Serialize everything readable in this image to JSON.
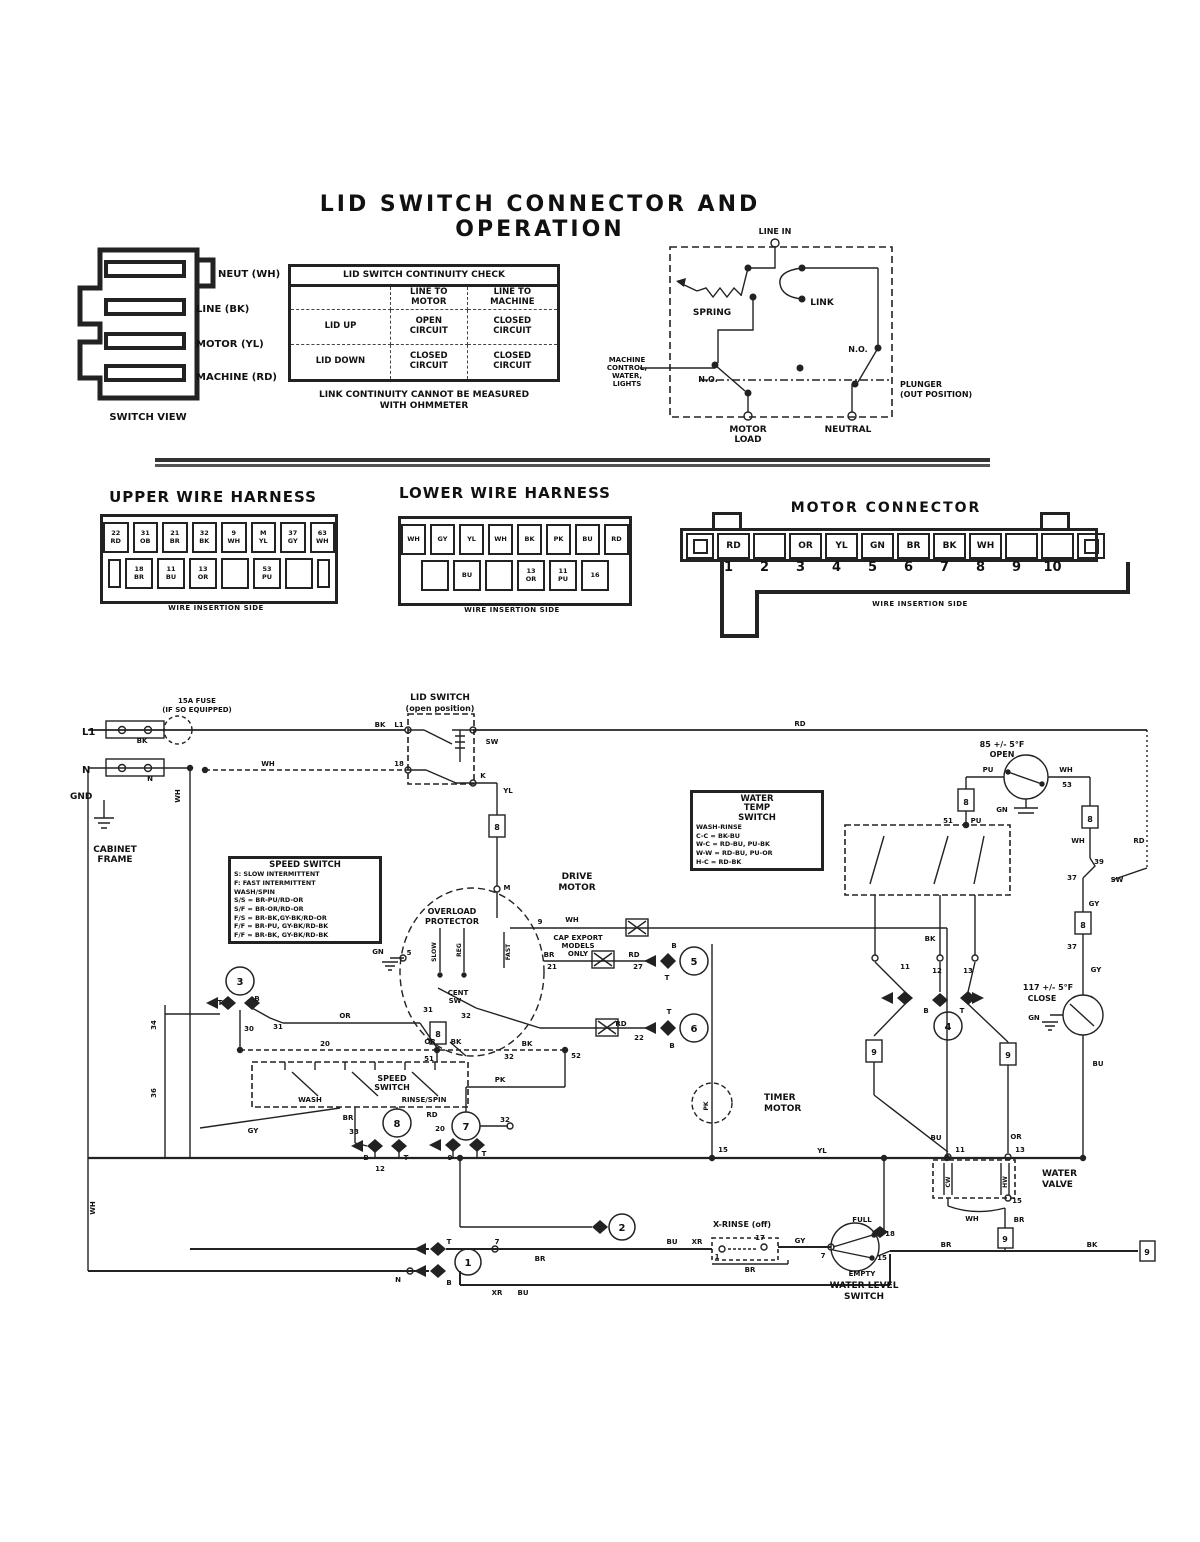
{
  "title": "LID SWITCH CONNECTOR AND OPERATION",
  "continuity_table": {
    "caption": "LID SWITCH CONTINUITY CHECK",
    "header": [
      "",
      "LINE TO|MOTOR",
      "LINE TO|MACHINE"
    ],
    "rows": [
      [
        "LID UP",
        "OPEN|CIRCUIT",
        "CLOSED|CIRCUIT"
      ],
      [
        "LID DOWN",
        "CLOSED|CIRCUIT",
        "CLOSED|CIRCUIT"
      ]
    ]
  },
  "footnote_line1": "LINK CONTINUITY CANNOT BE MEASURED",
  "footnote_line2": "WITH OHMMETER",
  "harnesses": {
    "upper": {
      "title": "UPPER WIRE HARNESS",
      "caption": "WIRE INSERTION SIDE",
      "row1": [
        "22|RD",
        "31|OB",
        "21|BR",
        "32|BK",
        "9|WH",
        "M|YL",
        "37|GY",
        "63|WH"
      ],
      "row2": [
        "18|BR",
        "11|BU",
        "13|OR",
        "",
        "53|PU",
        ""
      ]
    },
    "lower": {
      "title": "LOWER WIRE HARNESS",
      "caption": "WIRE INSERTION SIDE",
      "row1": [
        "WH",
        "GY",
        "YL",
        "WH",
        "BK",
        "PK",
        "BU",
        "RD"
      ],
      "row2": [
        "",
        "BU",
        "",
        "13|OR",
        "11|PU",
        "16"
      ]
    },
    "motor": {
      "title": "MOTOR CONNECTOR",
      "caption": "WIRE INSERTION SIDE",
      "cells": [
        "RD",
        "",
        "OR",
        "YL",
        "GN",
        "BR",
        "BK",
        "WH",
        "",
        ""
      ],
      "numbers": [
        "1",
        "2",
        "3",
        "4",
        "5",
        "6",
        "7",
        "8",
        "9",
        "10"
      ]
    }
  },
  "info_boxes": [
    {
      "x": 228,
      "y": 856,
      "w": 142,
      "title_lines": [
        "SPEED SWITCH"
      ],
      "lines": [
        "S:  SLOW INTERMITTENT",
        "F:  FAST INTERMITTENT",
        "WASH/SPIN",
        "S/S = BR-PU/RD-OR",
        "S/F = BR-OR/RD-OR",
        "F/S = BR-BK,GY-BK/RD-OR",
        "F/F = BR-PU, GY-BK/RD-BK",
        "F/F = BR-BK, GY-BK/RD-BK"
      ]
    },
    {
      "x": 690,
      "y": 790,
      "w": 122,
      "title_lines": [
        "WATER",
        "TEMP",
        "SWITCH"
      ],
      "lines": [
        "WASH-RINSE",
        "C-C = BK-BU",
        "W-C = RD-BU, PU-BK",
        "W-W = RD-BU, PU-OR",
        "H-C = RD-BK"
      ]
    }
  ],
  "svg_labels": [
    {
      "t": "NEUT (WH)",
      "x": 218,
      "y": 277,
      "s": 10,
      "a": "start"
    },
    {
      "t": "LINE (BK)",
      "x": 196,
      "y": 312,
      "s": 10,
      "a": "start"
    },
    {
      "t": "MOTOR (YL)",
      "x": 196,
      "y": 347,
      "s": 10,
      "a": "start"
    },
    {
      "t": "MACHINE (RD)",
      "x": 196,
      "y": 380,
      "s": 10,
      "a": "start"
    },
    {
      "t": "SWITCH VIEW",
      "x": 148,
      "y": 420,
      "s": 10
    },
    {
      "t": "LINE IN",
      "x": 775,
      "y": 234,
      "s": 8
    },
    {
      "t": "SPRING",
      "x": 712,
      "y": 315,
      "s": 9
    },
    {
      "t": "LINK",
      "x": 822,
      "y": 305,
      "s": 9
    },
    {
      "t": "N.O.",
      "x": 708,
      "y": 382,
      "s": 8
    },
    {
      "t": "N.O.",
      "x": 858,
      "y": 352,
      "s": 8
    },
    {
      "t": "MACHINE",
      "x": 627,
      "y": 362,
      "s": 7
    },
    {
      "t": "CONTROL,",
      "x": 627,
      "y": 370,
      "s": 7
    },
    {
      "t": "WATER,",
      "x": 627,
      "y": 378,
      "s": 7
    },
    {
      "t": "LIGHTS",
      "x": 627,
      "y": 386,
      "s": 7
    },
    {
      "t": "PLUNGER",
      "x": 900,
      "y": 387,
      "s": 8,
      "a": "start"
    },
    {
      "t": "(OUT POSITION)",
      "x": 900,
      "y": 397,
      "s": 8,
      "a": "start"
    },
    {
      "t": "MOTOR",
      "x": 748,
      "y": 432,
      "s": 9
    },
    {
      "t": "LOAD",
      "x": 748,
      "y": 442,
      "s": 9
    },
    {
      "t": "NEUTRAL",
      "x": 848,
      "y": 432,
      "s": 9
    },
    {
      "t": "15A FUSE",
      "x": 197,
      "y": 703,
      "s": 7
    },
    {
      "t": "(IF SO EQUIPPED)",
      "x": 197,
      "y": 712,
      "s": 7
    },
    {
      "t": "L1",
      "x": 82,
      "y": 735,
      "s": 10,
      "a": "start"
    },
    {
      "t": "BK",
      "x": 142,
      "y": 743,
      "s": 7
    },
    {
      "t": "N",
      "x": 82,
      "y": 773,
      "s": 10,
      "a": "start"
    },
    {
      "t": "N",
      "x": 150,
      "y": 781,
      "s": 7
    },
    {
      "t": "GND",
      "x": 70,
      "y": 799,
      "s": 9,
      "a": "start"
    },
    {
      "t": "WH",
      "x": 180,
      "y": 796,
      "s": 7,
      "r": -90
    },
    {
      "t": "CABINET",
      "x": 115,
      "y": 852,
      "s": 9
    },
    {
      "t": "FRAME",
      "x": 115,
      "y": 862,
      "s": 9
    },
    {
      "t": "LID SWITCH",
      "x": 440,
      "y": 700,
      "s": 9
    },
    {
      "t": "(open position)",
      "x": 440,
      "y": 711,
      "s": 8
    },
    {
      "t": "BK",
      "x": 380,
      "y": 727,
      "s": 7
    },
    {
      "t": "L1",
      "x": 399,
      "y": 727,
      "s": 7
    },
    {
      "t": "SW",
      "x": 492,
      "y": 744,
      "s": 7
    },
    {
      "t": "18",
      "x": 399,
      "y": 766,
      "s": 7
    },
    {
      "t": "K",
      "x": 483,
      "y": 778,
      "s": 7
    },
    {
      "t": "WH",
      "x": 268,
      "y": 766,
      "s": 7
    },
    {
      "t": "RD",
      "x": 800,
      "y": 726,
      "s": 7
    },
    {
      "t": "YL",
      "x": 508,
      "y": 793,
      "s": 7
    },
    {
      "t": "8",
      "x": 497,
      "y": 830,
      "s": 8
    },
    {
      "t": "M",
      "x": 507,
      "y": 890,
      "s": 7
    },
    {
      "t": "DRIVE",
      "x": 577,
      "y": 879,
      "s": 9
    },
    {
      "t": "MOTOR",
      "x": 577,
      "y": 890,
      "s": 9
    },
    {
      "t": "OVERLOAD",
      "x": 452,
      "y": 914,
      "s": 8
    },
    {
      "t": "PROTECTOR",
      "x": 452,
      "y": 924,
      "s": 8
    },
    {
      "t": "SLOW",
      "x": 436,
      "y": 952,
      "s": 6,
      "r": -90
    },
    {
      "t": "REG",
      "x": 461,
      "y": 950,
      "s": 6,
      "r": -90
    },
    {
      "t": "FAST",
      "x": 510,
      "y": 952,
      "s": 6,
      "r": -90
    },
    {
      "t": "CENT",
      "x": 458,
      "y": 995,
      "s": 7
    },
    {
      "t": "SW",
      "x": 455,
      "y": 1003,
      "s": 7
    },
    {
      "t": "31",
      "x": 428,
      "y": 1012,
      "s": 7
    },
    {
      "t": "32",
      "x": 466,
      "y": 1018,
      "s": 7
    },
    {
      "t": "GN",
      "x": 378,
      "y": 954,
      "s": 7
    },
    {
      "t": "5",
      "x": 409,
      "y": 955,
      "s": 7
    },
    {
      "t": "9",
      "x": 540,
      "y": 924,
      "s": 7
    },
    {
      "t": "WH",
      "x": 572,
      "y": 922,
      "s": 7
    },
    {
      "t": "CAP EXPORT",
      "x": 578,
      "y": 940,
      "s": 7
    },
    {
      "t": "MODELS",
      "x": 578,
      "y": 948,
      "s": 7
    },
    {
      "t": "ONLY",
      "x": 578,
      "y": 956,
      "s": 7
    },
    {
      "t": "BR",
      "x": 549,
      "y": 957,
      "s": 7
    },
    {
      "t": "21",
      "x": 552,
      "y": 969,
      "s": 7
    },
    {
      "t": "RD",
      "x": 634,
      "y": 957,
      "s": 7
    },
    {
      "t": "27",
      "x": 638,
      "y": 969,
      "s": 7
    },
    {
      "t": "B",
      "x": 674,
      "y": 948,
      "s": 7
    },
    {
      "t": "T",
      "x": 667,
      "y": 980,
      "s": 7
    },
    {
      "t": "5",
      "x": 694,
      "y": 965,
      "s": 10
    },
    {
      "t": "RD",
      "x": 621,
      "y": 1026,
      "s": 7
    },
    {
      "t": "22",
      "x": 639,
      "y": 1040,
      "s": 7
    },
    {
      "t": "T",
      "x": 669,
      "y": 1014,
      "s": 7
    },
    {
      "t": "B",
      "x": 672,
      "y": 1048,
      "s": 7
    },
    {
      "t": "6",
      "x": 694,
      "y": 1032,
      "s": 10
    },
    {
      "t": "BK",
      "x": 527,
      "y": 1046,
      "s": 7
    },
    {
      "t": "32",
      "x": 509,
      "y": 1059,
      "s": 7
    },
    {
      "t": "52",
      "x": 576,
      "y": 1058,
      "s": 7
    },
    {
      "t": "PK",
      "x": 500,
      "y": 1082,
      "s": 7
    },
    {
      "t": "OR",
      "x": 430,
      "y": 1044,
      "s": 7
    },
    {
      "t": "BK",
      "x": 456,
      "y": 1044,
      "s": 7
    },
    {
      "t": "51",
      "x": 429,
      "y": 1061,
      "s": 7
    },
    {
      "t": "8",
      "x": 438,
      "y": 1037,
      "s": 8
    },
    {
      "t": "3",
      "x": 240,
      "y": 985,
      "s": 10
    },
    {
      "t": "T",
      "x": 220,
      "y": 1005,
      "s": 7
    },
    {
      "t": "B",
      "x": 257,
      "y": 1001,
      "s": 7
    },
    {
      "t": "34",
      "x": 156,
      "y": 1025,
      "s": 7,
      "r": -90
    },
    {
      "t": "36",
      "x": 156,
      "y": 1093,
      "s": 7,
      "r": -90
    },
    {
      "t": "30",
      "x": 249,
      "y": 1031,
      "s": 7
    },
    {
      "t": "31",
      "x": 278,
      "y": 1029,
      "s": 7
    },
    {
      "t": "OR",
      "x": 345,
      "y": 1018,
      "s": 7
    },
    {
      "t": "20",
      "x": 325,
      "y": 1046,
      "s": 7
    },
    {
      "t": "GY",
      "x": 253,
      "y": 1133,
      "s": 7
    },
    {
      "t": "SPEED",
      "x": 392,
      "y": 1081,
      "s": 8
    },
    {
      "t": "SWITCH",
      "x": 392,
      "y": 1090,
      "s": 8
    },
    {
      "t": "WASH",
      "x": 310,
      "y": 1102,
      "s": 7
    },
    {
      "t": "RINSE/SPIN",
      "x": 424,
      "y": 1102,
      "s": 7
    },
    {
      "t": "BR",
      "x": 348,
      "y": 1120,
      "s": 7
    },
    {
      "t": "33",
      "x": 354,
      "y": 1134,
      "s": 7
    },
    {
      "t": "8",
      "x": 397,
      "y": 1127,
      "s": 10
    },
    {
      "t": "B",
      "x": 366,
      "y": 1160,
      "s": 7
    },
    {
      "t": "T",
      "x": 406,
      "y": 1160,
      "s": 7
    },
    {
      "t": "12",
      "x": 380,
      "y": 1171,
      "s": 7
    },
    {
      "t": "RD",
      "x": 432,
      "y": 1117,
      "s": 7
    },
    {
      "t": "20",
      "x": 440,
      "y": 1131,
      "s": 7
    },
    {
      "t": "7",
      "x": 466,
      "y": 1130,
      "s": 10
    },
    {
      "t": "32",
      "x": 505,
      "y": 1122,
      "s": 7
    },
    {
      "t": "9",
      "x": 450,
      "y": 1160,
      "s": 7
    },
    {
      "t": "T",
      "x": 484,
      "y": 1156,
      "s": 7
    },
    {
      "t": "TIMER",
      "x": 764,
      "y": 1100,
      "s": 9,
      "a": "start"
    },
    {
      "t": "MOTOR",
      "x": 764,
      "y": 1111,
      "s": 9,
      "a": "start"
    },
    {
      "t": "PK",
      "x": 708,
      "y": 1106,
      "s": 6,
      "r": -90
    },
    {
      "t": "15",
      "x": 723,
      "y": 1152,
      "s": 7
    },
    {
      "t": "YL",
      "x": 822,
      "y": 1153,
      "s": 7
    },
    {
      "t": "WH",
      "x": 95,
      "y": 1208,
      "s": 7,
      "r": -90
    },
    {
      "t": "85 +/- 5°F",
      "x": 1002,
      "y": 747,
      "s": 8
    },
    {
      "t": "OPEN",
      "x": 1002,
      "y": 757,
      "s": 8
    },
    {
      "t": "PU",
      "x": 988,
      "y": 772,
      "s": 7
    },
    {
      "t": "WH",
      "x": 1066,
      "y": 772,
      "s": 7
    },
    {
      "t": "53",
      "x": 1067,
      "y": 787,
      "s": 7
    },
    {
      "t": "GN",
      "x": 1002,
      "y": 812,
      "s": 7
    },
    {
      "t": "8",
      "x": 966,
      "y": 805,
      "s": 8
    },
    {
      "t": "8",
      "x": 1090,
      "y": 822,
      "s": 8
    },
    {
      "t": "51",
      "x": 948,
      "y": 823,
      "s": 7
    },
    {
      "t": "PU",
      "x": 976,
      "y": 823,
      "s": 7
    },
    {
      "t": "WH",
      "x": 1078,
      "y": 843,
      "s": 7
    },
    {
      "t": "RD",
      "x": 1139,
      "y": 843,
      "s": 7
    },
    {
      "t": "39",
      "x": 1099,
      "y": 864,
      "s": 7
    },
    {
      "t": "37",
      "x": 1072,
      "y": 880,
      "s": 7
    },
    {
      "t": "SW",
      "x": 1117,
      "y": 882,
      "s": 7
    },
    {
      "t": "GY",
      "x": 1094,
      "y": 906,
      "s": 7
    },
    {
      "t": "8",
      "x": 1083,
      "y": 928,
      "s": 8
    },
    {
      "t": "37",
      "x": 1072,
      "y": 949,
      "s": 7
    },
    {
      "t": "GY",
      "x": 1096,
      "y": 972,
      "s": 7
    },
    {
      "t": "BK",
      "x": 930,
      "y": 941,
      "s": 7
    },
    {
      "t": "11",
      "x": 905,
      "y": 969,
      "s": 7
    },
    {
      "t": "12",
      "x": 937,
      "y": 973,
      "s": 7
    },
    {
      "t": "13",
      "x": 968,
      "y": 973,
      "s": 7
    },
    {
      "t": "B",
      "x": 926,
      "y": 1013,
      "s": 7
    },
    {
      "t": "T",
      "x": 962,
      "y": 1013,
      "s": 7
    },
    {
      "t": "4",
      "x": 948,
      "y": 1030,
      "s": 10
    },
    {
      "t": "117 +/- 5°F",
      "x": 1048,
      "y": 990,
      "s": 8
    },
    {
      "t": "CLOSE",
      "x": 1042,
      "y": 1001,
      "s": 8
    },
    {
      "t": "GN",
      "x": 1034,
      "y": 1020,
      "s": 7
    },
    {
      "t": "BU",
      "x": 1098,
      "y": 1066,
      "s": 7
    },
    {
      "t": "9",
      "x": 874,
      "y": 1055,
      "s": 8
    },
    {
      "t": "9",
      "x": 1008,
      "y": 1058,
      "s": 8
    },
    {
      "t": "BU",
      "x": 936,
      "y": 1140,
      "s": 7
    },
    {
      "t": "OR",
      "x": 1016,
      "y": 1139,
      "s": 7
    },
    {
      "t": "11",
      "x": 960,
      "y": 1152,
      "s": 7
    },
    {
      "t": "13",
      "x": 1020,
      "y": 1152,
      "s": 7
    },
    {
      "t": "WATER",
      "x": 1042,
      "y": 1176,
      "s": 9,
      "a": "start"
    },
    {
      "t": "VALVE",
      "x": 1042,
      "y": 1187,
      "s": 9,
      "a": "start"
    },
    {
      "t": "CW",
      "x": 950,
      "y": 1182,
      "s": 6,
      "r": -90
    },
    {
      "t": "HW",
      "x": 1007,
      "y": 1182,
      "s": 6,
      "r": -90
    },
    {
      "t": "WH",
      "x": 972,
      "y": 1221,
      "s": 7
    },
    {
      "t": "15",
      "x": 1017,
      "y": 1203,
      "s": 7
    },
    {
      "t": "BR",
      "x": 1019,
      "y": 1222,
      "s": 7
    },
    {
      "t": "9",
      "x": 1005,
      "y": 1242,
      "s": 8
    },
    {
      "t": "BR",
      "x": 946,
      "y": 1247,
      "s": 7
    },
    {
      "t": "BK",
      "x": 1092,
      "y": 1247,
      "s": 7
    },
    {
      "t": "9",
      "x": 1147,
      "y": 1255,
      "s": 8
    },
    {
      "t": "X-RINSE (off)",
      "x": 742,
      "y": 1227,
      "s": 8
    },
    {
      "t": "BU",
      "x": 672,
      "y": 1244,
      "s": 7
    },
    {
      "t": "XR",
      "x": 697,
      "y": 1244,
      "s": 7
    },
    {
      "t": "1",
      "x": 717,
      "y": 1259,
      "s": 7
    },
    {
      "t": "17",
      "x": 760,
      "y": 1240,
      "s": 7
    },
    {
      "t": "GY",
      "x": 800,
      "y": 1243,
      "s": 7
    },
    {
      "t": "BR",
      "x": 750,
      "y": 1272,
      "s": 7
    },
    {
      "t": "FULL",
      "x": 862,
      "y": 1222,
      "s": 7
    },
    {
      "t": "18",
      "x": 890,
      "y": 1236,
      "s": 7
    },
    {
      "t": "7",
      "x": 823,
      "y": 1258,
      "s": 7
    },
    {
      "t": "15",
      "x": 882,
      "y": 1260,
      "s": 7
    },
    {
      "t": "EMPTY",
      "x": 862,
      "y": 1276,
      "s": 7
    },
    {
      "t": "WATER LEVEL",
      "x": 864,
      "y": 1288,
      "s": 9
    },
    {
      "t": "SWITCH",
      "x": 864,
      "y": 1299,
      "s": 9
    },
    {
      "t": "N",
      "x": 398,
      "y": 1282,
      "s": 7
    },
    {
      "t": "T",
      "x": 449,
      "y": 1244,
      "s": 7
    },
    {
      "t": "B",
      "x": 449,
      "y": 1285,
      "s": 7
    },
    {
      "t": "1",
      "x": 468,
      "y": 1266,
      "s": 10
    },
    {
      "t": "7",
      "x": 497,
      "y": 1244,
      "s": 7
    },
    {
      "t": "BR",
      "x": 540,
      "y": 1261,
      "s": 7
    },
    {
      "t": "2",
      "x": 622,
      "y": 1231,
      "s": 10
    },
    {
      "t": "XR",
      "x": 497,
      "y": 1295,
      "s": 7
    },
    {
      "t": "BU",
      "x": 523,
      "y": 1295,
      "s": 7
    }
  ]
}
